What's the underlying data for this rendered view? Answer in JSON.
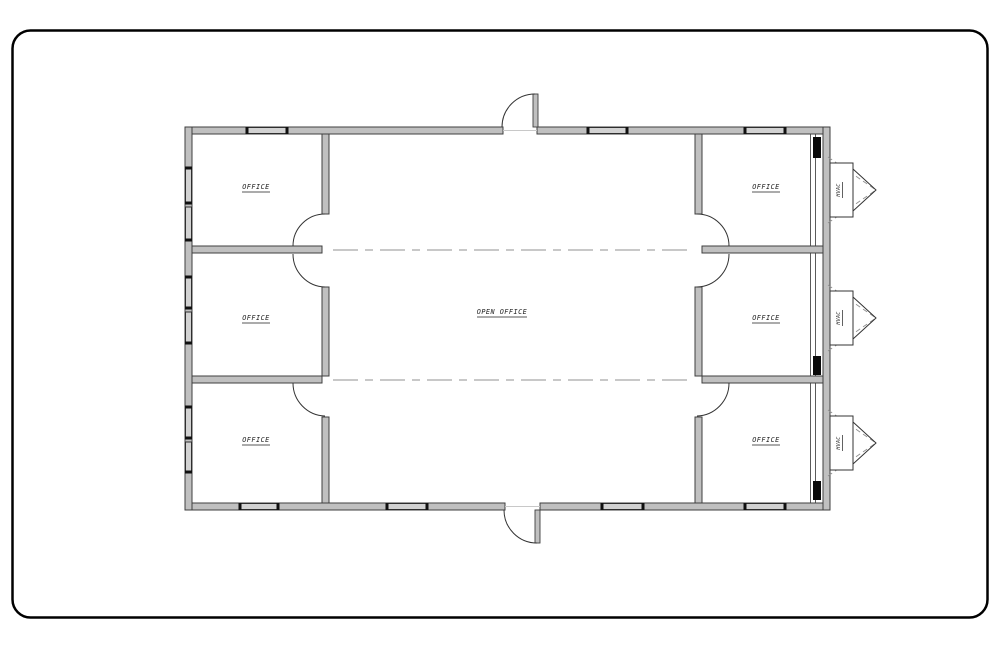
{
  "drawing": {
    "type": "office building floor plan",
    "rooms": [
      {
        "name": "office-top-left",
        "label": "OFFICE"
      },
      {
        "name": "office-middle-left",
        "label": "OFFICE"
      },
      {
        "name": "office-bottom-left",
        "label": "OFFICE"
      },
      {
        "name": "office-top-right",
        "label": "OFFICE"
      },
      {
        "name": "office-middle-right",
        "label": "OFFICE"
      },
      {
        "name": "office-bottom-right",
        "label": "OFFICE"
      },
      {
        "name": "open-office",
        "label": "OPEN OFFICE"
      }
    ],
    "hvac_units": [
      {
        "label": "HVAC"
      },
      {
        "label": "HVAC"
      },
      {
        "label": "HVAC"
      }
    ],
    "colors": {
      "wall_fill": "#c0c0c0",
      "wall_edge": "#3f3f3f",
      "window_fill": "#d2d2d2",
      "door_line": "#333333",
      "centerline": "#b5b5b5",
      "hvac_dash": "#8f8f8f",
      "label_text": "#1f1f1f",
      "card_border": "#000000",
      "background": "#ffffff"
    }
  }
}
